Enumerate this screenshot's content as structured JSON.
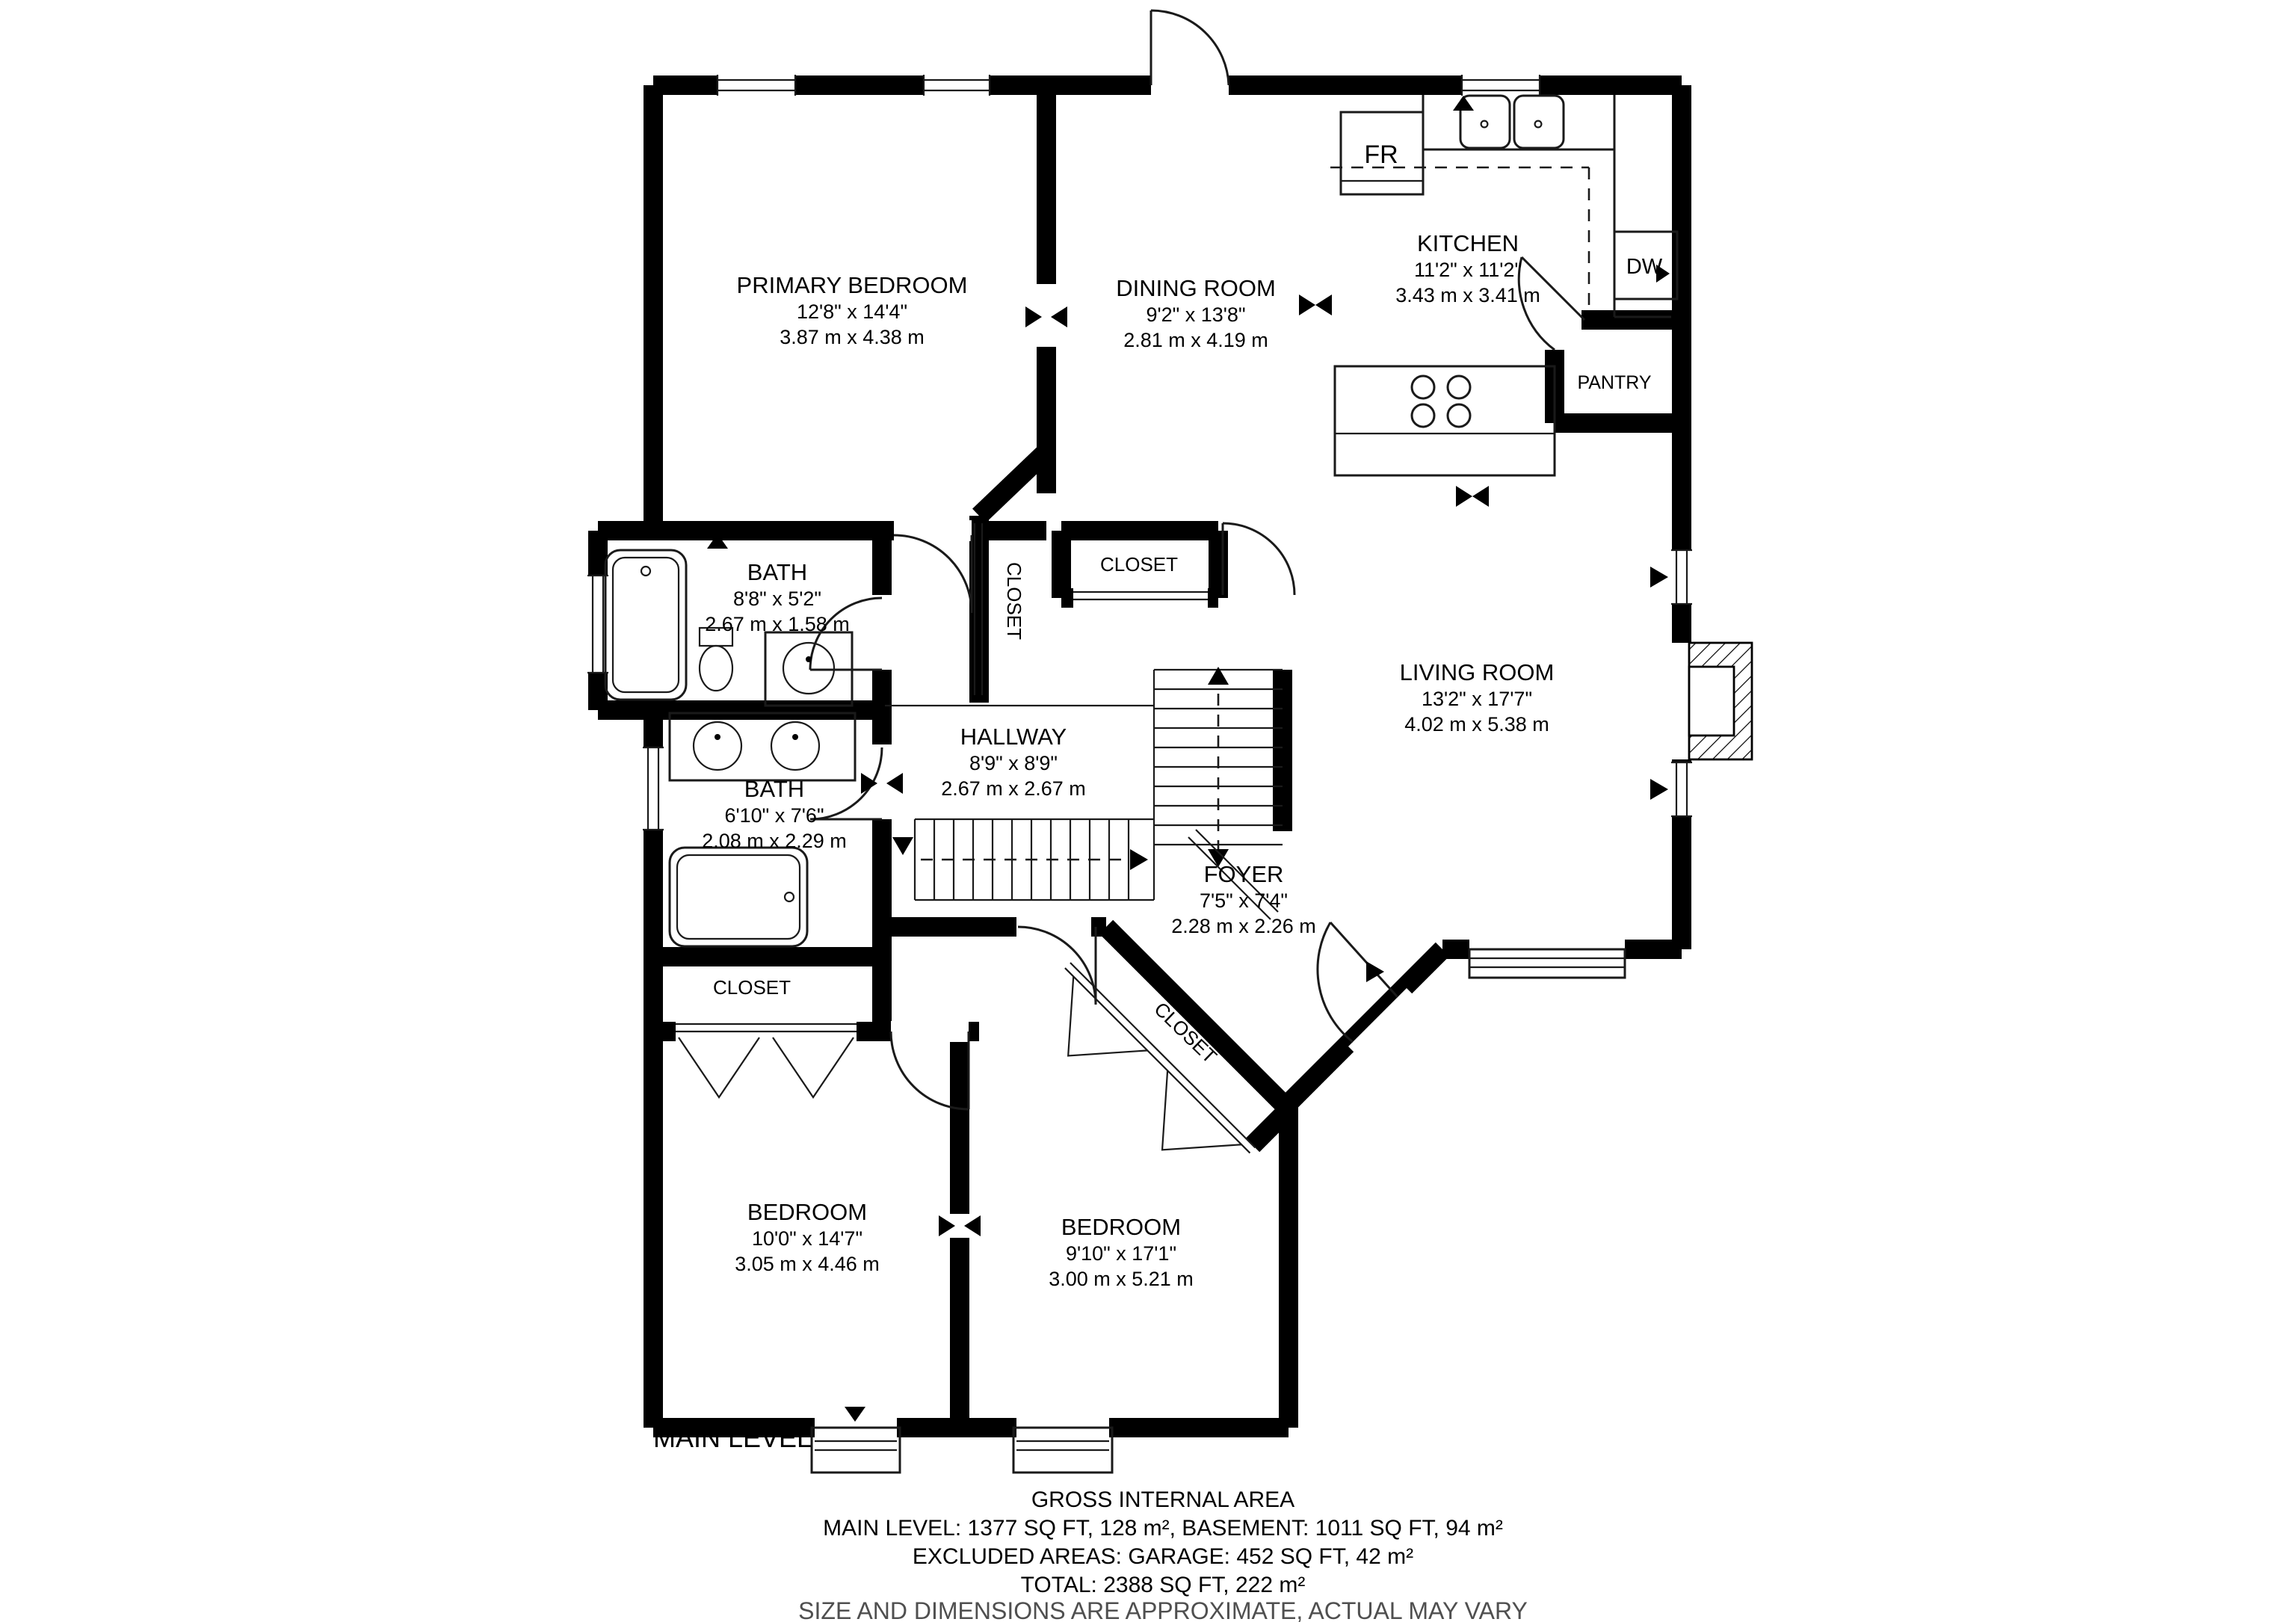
{
  "level_label": "MAIN LEVEL",
  "rooms": [
    {
      "name": "PRIMARY BEDROOM",
      "imperial": "12'8\" x 14'4\"",
      "metric": "3.87 m x 4.38 m"
    },
    {
      "name": "DINING ROOM",
      "imperial": "9'2\" x 13'8\"",
      "metric": "2.81 m x 4.19 m"
    },
    {
      "name": "KITCHEN",
      "imperial": "11'2\" x 11'2\"",
      "metric": "3.43 m x 3.41 m"
    },
    {
      "name": "LIVING ROOM",
      "imperial": "13'2\" x 17'7\"",
      "metric": "4.02 m x 5.38 m"
    },
    {
      "name": "BATH",
      "imperial": "8'8\" x 5'2\"",
      "metric": "2.67 m x 1.58 m"
    },
    {
      "name": "BATH",
      "imperial": "6'10\" x 7'6\"",
      "metric": "2.08 m x 2.29 m"
    },
    {
      "name": "HALLWAY",
      "imperial": "8'9\" x 8'9\"",
      "metric": "2.67 m x 2.67 m"
    },
    {
      "name": "FOYER",
      "imperial": "7'5\" x 7'4\"",
      "metric": "2.28 m x 2.26 m"
    },
    {
      "name": "BEDROOM",
      "imperial": "10'0\" x 14'7\"",
      "metric": "3.05 m x 4.46 m"
    },
    {
      "name": "BEDROOM",
      "imperial": "9'10\" x 17'1\"",
      "metric": "3.00 m x 5.21 m"
    }
  ],
  "closets": [
    "CLOSET",
    "CLOSET",
    "CLOSET",
    "CLOSET"
  ],
  "appliances": {
    "fridge": "FR",
    "dishwasher": "DW",
    "pantry": "PANTRY"
  },
  "footer": {
    "heading": "GROSS INTERNAL AREA",
    "main_line": "MAIN LEVEL: 1377 SQ FT, 128 m², BASEMENT: 1011 SQ FT, 94 m²",
    "excluded_line": "EXCLUDED AREAS: GARAGE: 452 SQ FT, 42 m²",
    "total_line": "TOTAL: 2388 SQ FT, 222 m²",
    "disclaimer": "SIZE AND DIMENSIONS ARE APPROXIMATE, ACTUAL MAY VARY"
  },
  "colors": {
    "wall": "#000000",
    "muted_text": "#4f4f4f",
    "background": "#ffffff"
  }
}
